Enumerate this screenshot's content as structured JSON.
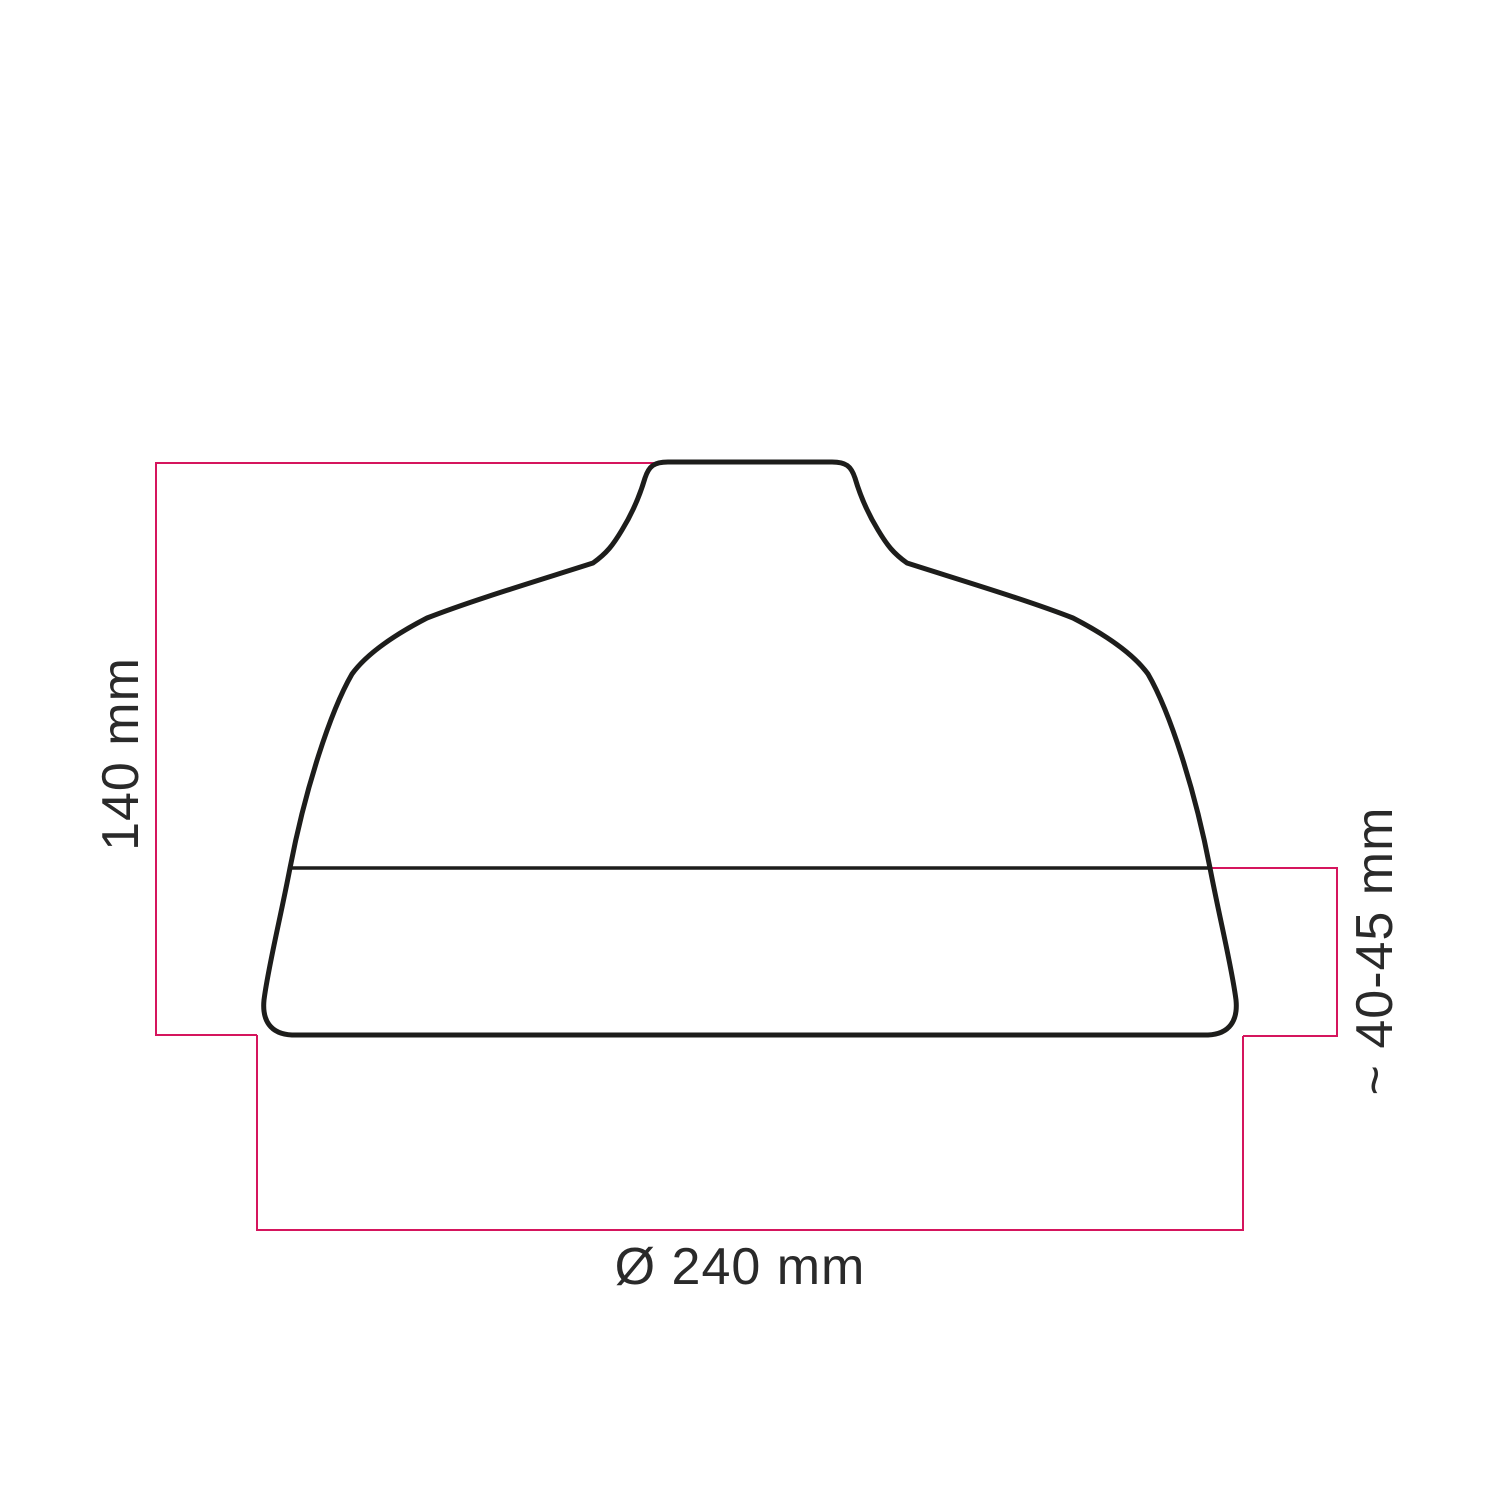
{
  "diagram": {
    "name": "lampshade-dimension-drawing",
    "background_color": "#ffffff",
    "outline_color": "#1d1d1b",
    "accent_color": "#d5155d",
    "text_color": "#2a2a2a",
    "dimensions": {
      "height_label": "140 mm",
      "rim_label": "~ 40-45 mm",
      "diameter_label": "Ø 240 mm"
    }
  }
}
